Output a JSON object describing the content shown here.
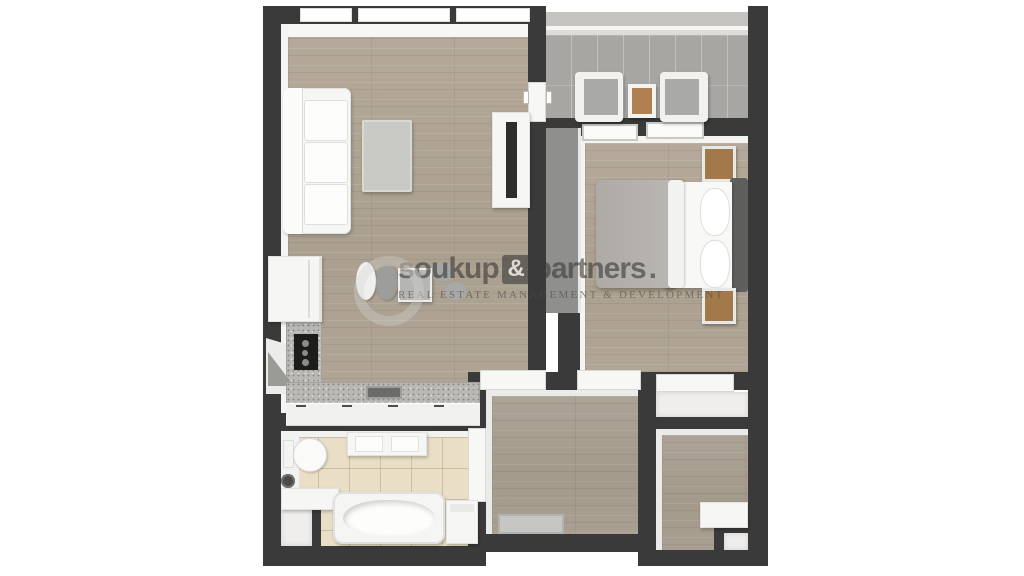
{
  "meta": {
    "description": "3D rendered top-down floor plan of a one-bedroom apartment",
    "canvas": {
      "width": 1024,
      "height": 576
    }
  },
  "watermark": {
    "brand_first": "soukup",
    "amp": "&",
    "brand_second": "partners",
    "period": ".",
    "tagline": "REAL ESTATE MANAGEMENT & DEVELOPMENT"
  },
  "colors": {
    "background": "#ffffff",
    "wall_dark": "#3a3a3a",
    "wall_inner_face": "#f4f4f3",
    "balcony_wall": "#c5c4c1",
    "floor_wood": "#b0a596",
    "floor_tile_balcony": "#a7a6a2",
    "floor_tile_bathroom": "#e9dfc6",
    "closet_floor": "#efeeec",
    "countertop": "#b9b8b4",
    "cooktop": "#1d1d1c",
    "wardrobe": "#8f8f8d",
    "headboard": "#5f5f5d",
    "blanket": "#b5b1ac",
    "nightstand_wood": "#a2794b",
    "balcony_table_top": "#b08050",
    "watermark_text": "#3c3c3c"
  },
  "legend": {
    "rooms": [
      {
        "name": "living-room",
        "furniture": [
          "sofa",
          "coffee-table",
          "tv-cabinet",
          "tv",
          "dining-table",
          "dining-chairs"
        ]
      },
      {
        "name": "kitchen",
        "furniture": [
          "fridge",
          "corner-cabinet",
          "cooktop",
          "counter",
          "sink"
        ]
      },
      {
        "name": "balcony",
        "furniture": [
          "armchair-left",
          "side-table",
          "armchair-right"
        ]
      },
      {
        "name": "bedroom",
        "furniture": [
          "double-bed",
          "blanket",
          "pillows",
          "headboard",
          "nightstand-top",
          "nightstand-bottom",
          "wardrobe"
        ]
      },
      {
        "name": "bathroom",
        "furniture": [
          "toilet",
          "floor-drain",
          "vanity",
          "shelf",
          "bathtub",
          "washing-machine"
        ]
      },
      {
        "name": "entrance-hall",
        "furniture": [
          "doormat"
        ]
      },
      {
        "name": "hallway",
        "furniture": [
          "bench"
        ]
      },
      {
        "name": "walk-in-closet",
        "furniture": []
      },
      {
        "name": "bathroom-closet",
        "furniture": []
      },
      {
        "name": "storage-closet",
        "furniture": []
      }
    ]
  }
}
